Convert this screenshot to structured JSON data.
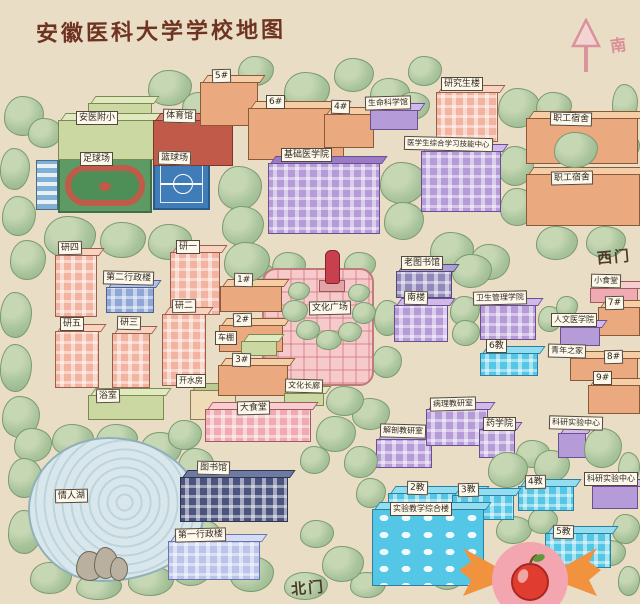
{
  "title": "安徽医科大学学校地图",
  "compass": {
    "label": "南"
  },
  "map": {
    "bg": "#e9ddc6",
    "palettes": {
      "orange": {
        "body": "#eaa97e",
        "top": "#f5cda6",
        "ln": "#8a5a38"
      },
      "pink": {
        "body": "#f2b4a0",
        "top": "#f8d4c0",
        "ln": "#9a5f4a"
      },
      "pinkC": {
        "body": "#f0abb2",
        "top": "#f8cdd0",
        "ln": "#a05a60"
      },
      "purple": {
        "body": "#b69bd9",
        "top": "#cfbae9",
        "ln": "#6c4f92"
      },
      "dpurple": {
        "body": "#9187bb",
        "top": "#aba0cf",
        "ln": "#55497a"
      },
      "cyan": {
        "body": "#55c7e6",
        "top": "#93ddf1",
        "ln": "#2d7fa0"
      },
      "navy": {
        "body": "#4a547e",
        "top": "#6f7aa4",
        "ln": "#2e3550"
      },
      "lav": {
        "body": "#bac4eb",
        "top": "#d5dcf5",
        "ln": "#6a74a8"
      },
      "green": {
        "body": "#cbd8a2",
        "top": "#e1e9c0",
        "ln": "#7c8a52"
      },
      "cream": {
        "body": "#eddcb6",
        "top": "#b9ca92",
        "ln": "#8a7a4e"
      },
      "red": {
        "body": "#c25a4a",
        "top": "#da8272",
        "ln": "#7e352a"
      },
      "blue2": {
        "body": "#8fa7d7",
        "top": "#b3c3e8",
        "ln": "#4e6394"
      }
    },
    "items": [
      {
        "id": "fuxiao-annex",
        "pal": "green",
        "x": 88,
        "y": 103,
        "w": 64,
        "h": 30
      },
      {
        "id": "fuxiao",
        "label": "安医附小",
        "pal": "green",
        "x": 58,
        "y": 120,
        "w": 96,
        "h": 40,
        "lx": 76,
        "ly": 111
      },
      {
        "id": "gym",
        "label": "体育馆",
        "pal": "red",
        "x": 153,
        "y": 120,
        "w": 80,
        "h": 46,
        "lx": 163,
        "ly": 109
      },
      {
        "id": "stands",
        "type": "stands",
        "x": 36,
        "y": 160,
        "w": 22,
        "h": 50
      },
      {
        "id": "football-field",
        "type": "field",
        "label": "足球场",
        "x": 58,
        "y": 158,
        "w": 94,
        "h": 55,
        "lx": 80,
        "ly": 152
      },
      {
        "id": "basketball-court",
        "type": "court",
        "label": "篮球场",
        "x": 153,
        "y": 156,
        "w": 57,
        "h": 54,
        "lx": 158,
        "ly": 151
      },
      {
        "id": "bld5",
        "label": "5#",
        "pal": "orange",
        "x": 200,
        "y": 82,
        "w": 58,
        "h": 44,
        "lx": 212,
        "ly": 69
      },
      {
        "id": "bld6",
        "label": "6#",
        "pal": "orange",
        "x": 248,
        "y": 108,
        "w": 96,
        "h": 52,
        "lx": 266,
        "ly": 95
      },
      {
        "id": "bld4",
        "label": "4#",
        "pal": "orange",
        "x": 324,
        "y": 114,
        "w": 50,
        "h": 34,
        "lx": 331,
        "ly": 100
      },
      {
        "id": "life-science",
        "label": "生命科学馆",
        "pal": "purple",
        "x": 370,
        "y": 110,
        "w": 48,
        "h": 20,
        "lx": 365,
        "ly": 96,
        "fs": 8
      },
      {
        "id": "grad-bld",
        "label": "研究生楼",
        "pal": "pink",
        "x": 436,
        "y": 92,
        "w": 62,
        "h": 50,
        "win": 1,
        "lx": 441,
        "ly": 77
      },
      {
        "id": "staff-dorm-1",
        "label": "职工宿舍",
        "pal": "orange",
        "x": 526,
        "y": 118,
        "w": 112,
        "h": 46,
        "lx": 550,
        "ly": 112
      },
      {
        "id": "staff-dorm-2",
        "label": "职工宿舍",
        "pal": "orange",
        "x": 526,
        "y": 174,
        "w": 114,
        "h": 52,
        "lx": 551,
        "ly": 171
      },
      {
        "id": "basic-medical",
        "label": "基础医学院",
        "pal": "purple",
        "top": "#9a7cc4",
        "x": 268,
        "y": 163,
        "w": 112,
        "h": 71,
        "win": 1,
        "lx": 281,
        "ly": 148
      },
      {
        "id": "skill-center",
        "label": "医学生综合学习技能中心",
        "pal": "purple",
        "x": 421,
        "y": 151,
        "w": 80,
        "h": 61,
        "win": 1,
        "lx": 404,
        "ly": 137,
        "fs": 7.5
      },
      {
        "id": "yan4",
        "label": "研四",
        "pal": "pink",
        "x": 55,
        "y": 255,
        "w": 42,
        "h": 62,
        "win": 1,
        "lx": 58,
        "ly": 241
      },
      {
        "id": "yan1",
        "label": "研一",
        "pal": "pink",
        "x": 170,
        "y": 252,
        "w": 50,
        "h": 63,
        "win": 1,
        "lx": 176,
        "ly": 240
      },
      {
        "id": "admin2",
        "label": "第二行政楼",
        "pal": "blue2",
        "x": 106,
        "y": 287,
        "w": 48,
        "h": 26,
        "win": 1,
        "lx": 103,
        "ly": 271
      },
      {
        "id": "yan2",
        "label": "研二",
        "pal": "pink",
        "x": 162,
        "y": 314,
        "w": 44,
        "h": 72,
        "win": 1,
        "lx": 172,
        "ly": 299
      },
      {
        "id": "yan5",
        "label": "研五",
        "pal": "pink",
        "x": 55,
        "y": 331,
        "w": 44,
        "h": 57,
        "win": 1,
        "lx": 60,
        "ly": 317
      },
      {
        "id": "yan3",
        "label": "研三",
        "pal": "pink",
        "x": 112,
        "y": 333,
        "w": 38,
        "h": 55,
        "win": 1,
        "lx": 117,
        "ly": 316
      },
      {
        "id": "bathhouse",
        "label": "浴室",
        "pal": "green",
        "x": 88,
        "y": 395,
        "w": 76,
        "h": 25,
        "lx": 96,
        "ly": 389
      },
      {
        "id": "hot-water",
        "label": "开水房",
        "pal": "cream",
        "x": 190,
        "y": 390,
        "w": 46,
        "h": 30,
        "lx": 176,
        "ly": 374,
        "fs": 8
      },
      {
        "id": "bld1",
        "label": "1#",
        "pal": "orange",
        "x": 220,
        "y": 286,
        "w": 62,
        "h": 26,
        "lx": 234,
        "ly": 273
      },
      {
        "id": "bld2",
        "label": "2#",
        "pal": "orange",
        "x": 219,
        "y": 325,
        "w": 64,
        "h": 27,
        "lx": 233,
        "ly": 313
      },
      {
        "id": "bike-shed",
        "label": "车棚",
        "pal": "green",
        "x": 241,
        "y": 341,
        "w": 36,
        "h": 15,
        "lx": 215,
        "ly": 331,
        "fs": 8
      },
      {
        "id": "bld3",
        "label": "3#",
        "pal": "orange",
        "x": 218,
        "y": 365,
        "w": 70,
        "h": 31,
        "lx": 232,
        "ly": 353
      },
      {
        "id": "culture-square",
        "type": "plaid",
        "label": "文化广场",
        "x": 262,
        "y": 268,
        "w": 112,
        "h": 118,
        "lx": 309,
        "ly": 301
      },
      {
        "id": "statue",
        "type": "statue",
        "x": 319,
        "y": 250,
        "w": 24,
        "h": 42
      },
      {
        "id": "culture-corridor",
        "label": "文化长廊",
        "pal": "green",
        "x": 284,
        "y": 393,
        "w": 40,
        "h": 13,
        "lx": 285,
        "ly": 379,
        "fs": 8
      },
      {
        "id": "canteen-big",
        "label": "大食堂",
        "pal": "pinkC",
        "x": 205,
        "y": 409,
        "w": 106,
        "h": 33,
        "win": 1,
        "lx": 237,
        "ly": 401
      },
      {
        "id": "old-library",
        "label": "老图书馆",
        "pal": "dpurple",
        "x": 396,
        "y": 271,
        "w": 56,
        "h": 27,
        "win": 1,
        "lx": 401,
        "ly": 256
      },
      {
        "id": "south-bld",
        "label": "南楼",
        "pal": "purple",
        "x": 394,
        "y": 305,
        "w": 54,
        "h": 37,
        "win": 1,
        "lx": 404,
        "ly": 291
      },
      {
        "id": "health-mgmt",
        "label": "卫生管理学院",
        "pal": "purple",
        "x": 480,
        "y": 305,
        "w": 56,
        "h": 35,
        "win": 1,
        "lx": 473,
        "ly": 291,
        "fs": 8
      },
      {
        "id": "jiao6",
        "label": "6教",
        "pal": "cyan",
        "x": 480,
        "y": 353,
        "w": 58,
        "h": 23,
        "win": 1,
        "lx": 486,
        "ly": 339
      },
      {
        "id": "small-canteen",
        "label": "小食堂",
        "pal": "pinkC",
        "x": 590,
        "y": 288,
        "w": 48,
        "h": 15,
        "lx": 591,
        "ly": 274,
        "fs": 8
      },
      {
        "id": "bld7",
        "label": "7#",
        "pal": "orange",
        "x": 598,
        "y": 307,
        "w": 42,
        "h": 29,
        "lx": 605,
        "ly": 296
      },
      {
        "id": "humanities",
        "label": "人文医学院",
        "pal": "purple",
        "x": 560,
        "y": 327,
        "w": 40,
        "h": 19,
        "lx": 551,
        "ly": 313,
        "fs": 8
      },
      {
        "id": "youth-home",
        "type": "label-only",
        "label": "青年之家",
        "lx": 548,
        "ly": 344,
        "fs": 8
      },
      {
        "id": "bld8",
        "label": "8#",
        "pal": "orange",
        "x": 570,
        "y": 358,
        "w": 68,
        "h": 23,
        "lx": 604,
        "ly": 350
      },
      {
        "id": "bld9",
        "label": "9#",
        "pal": "orange",
        "x": 588,
        "y": 385,
        "w": 52,
        "h": 29,
        "lx": 593,
        "ly": 371
      },
      {
        "id": "anatomy",
        "label": "解剖教研室",
        "pal": "purple",
        "x": 376,
        "y": 439,
        "w": 56,
        "h": 29,
        "win": 1,
        "lx": 380,
        "ly": 424,
        "fs": 8
      },
      {
        "id": "pathology",
        "label": "病理教研室",
        "pal": "purple",
        "x": 426,
        "y": 409,
        "w": 62,
        "h": 37,
        "win": 1,
        "lx": 430,
        "ly": 397,
        "fs": 8
      },
      {
        "id": "pharmacy",
        "label": "药学院",
        "pal": "purple",
        "x": 479,
        "y": 429,
        "w": 36,
        "h": 29,
        "win": 1,
        "lx": 483,
        "ly": 417
      },
      {
        "id": "research-center-1",
        "label": "科研实验中心",
        "pal": "purple",
        "x": 558,
        "y": 433,
        "w": 28,
        "h": 25,
        "lx": 549,
        "ly": 416,
        "fs": 8
      },
      {
        "id": "jiao4",
        "label": "4教",
        "pal": "cyan",
        "x": 518,
        "y": 486,
        "w": 56,
        "h": 25,
        "win": 1,
        "lx": 525,
        "ly": 475
      },
      {
        "id": "research-center-2",
        "label": "科研实验中心",
        "pal": "purple",
        "x": 592,
        "y": 486,
        "w": 46,
        "h": 23,
        "lx": 584,
        "ly": 472,
        "fs": 8
      },
      {
        "id": "jiao2",
        "label": "2教",
        "pal": "cyan",
        "x": 388,
        "y": 493,
        "w": 94,
        "h": 23,
        "win": 1,
        "lx": 407,
        "ly": 481
      },
      {
        "id": "jiao3",
        "label": "3教",
        "pal": "cyan",
        "x": 452,
        "y": 495,
        "w": 62,
        "h": 25,
        "win": 1,
        "lx": 458,
        "ly": 483
      },
      {
        "id": "exp-teaching",
        "label": "实验教学综合楼",
        "pal": "cyan",
        "x": 372,
        "y": 509,
        "w": 112,
        "h": 77,
        "win": "oval",
        "lx": 390,
        "ly": 502,
        "fs": 8
      },
      {
        "id": "jiao5",
        "label": "5教",
        "pal": "cyan",
        "x": 545,
        "y": 533,
        "w": 66,
        "h": 35,
        "win": 1,
        "lx": 553,
        "ly": 525
      },
      {
        "id": "lovers-lake",
        "type": "lake",
        "label": "情人湖",
        "x": 28,
        "y": 437,
        "w": 176,
        "h": 145,
        "lx": 55,
        "ly": 489
      },
      {
        "id": "rocks",
        "type": "rocks",
        "x": 76,
        "y": 545,
        "w": 50,
        "h": 34
      },
      {
        "id": "library",
        "label": "图书馆",
        "pal": "navy",
        "x": 180,
        "y": 477,
        "w": 108,
        "h": 45,
        "win": 1,
        "lx": 197,
        "ly": 461
      },
      {
        "id": "admin1",
        "label": "第一行政楼",
        "pal": "lav",
        "x": 168,
        "y": 541,
        "w": 92,
        "h": 39,
        "win": 1,
        "lx": 175,
        "ly": 528
      },
      {
        "id": "west-gate",
        "type": "gate",
        "label": "西门",
        "lx": 597,
        "ly": 246
      },
      {
        "id": "north-gate",
        "type": "gate",
        "label": "北门",
        "lx": 291,
        "ly": 577
      }
    ]
  },
  "decor": {
    "trees": [
      [
        4,
        96,
        40,
        40
      ],
      [
        28,
        118,
        34,
        30
      ],
      [
        0,
        148,
        30,
        42
      ],
      [
        2,
        196,
        34,
        40
      ],
      [
        148,
        70,
        44,
        36
      ],
      [
        182,
        92,
        36,
        30
      ],
      [
        238,
        56,
        36,
        30
      ],
      [
        284,
        72,
        46,
        38
      ],
      [
        334,
        58,
        40,
        34
      ],
      [
        370,
        78,
        40,
        32
      ],
      [
        408,
        56,
        34,
        30
      ],
      [
        396,
        92,
        34,
        28
      ],
      [
        498,
        88,
        42,
        40
      ],
      [
        536,
        92,
        36,
        30
      ],
      [
        612,
        84,
        26,
        40
      ],
      [
        554,
        132,
        44,
        36,
        1
      ],
      [
        604,
        132,
        36,
        30
      ],
      [
        498,
        146,
        36,
        40
      ],
      [
        500,
        188,
        36,
        38
      ],
      [
        536,
        226,
        42,
        34
      ],
      [
        586,
        226,
        40,
        32
      ],
      [
        44,
        216,
        52,
        42
      ],
      [
        100,
        222,
        46,
        36
      ],
      [
        148,
        224,
        44,
        36
      ],
      [
        10,
        240,
        36,
        40
      ],
      [
        0,
        292,
        32,
        46
      ],
      [
        0,
        344,
        32,
        48
      ],
      [
        2,
        396,
        38,
        42
      ],
      [
        218,
        166,
        44,
        44
      ],
      [
        222,
        206,
        42,
        40
      ],
      [
        224,
        242,
        46,
        40,
        1
      ],
      [
        190,
        280,
        26,
        30
      ],
      [
        380,
        162,
        46,
        42
      ],
      [
        384,
        202,
        40,
        38
      ],
      [
        430,
        232,
        44,
        38
      ],
      [
        470,
        244,
        40,
        36
      ],
      [
        272,
        252,
        34,
        28
      ],
      [
        344,
        252,
        32,
        26
      ],
      [
        374,
        300,
        28,
        36
      ],
      [
        372,
        346,
        30,
        32
      ],
      [
        326,
        386,
        38,
        30,
        1
      ],
      [
        246,
        262,
        28,
        24
      ],
      [
        452,
        254,
        40,
        34
      ],
      [
        450,
        296,
        30,
        30
      ],
      [
        452,
        320,
        28,
        26
      ],
      [
        538,
        306,
        24,
        26
      ],
      [
        556,
        296,
        22,
        22
      ],
      [
        14,
        428,
        38,
        34
      ],
      [
        52,
        424,
        42,
        32
      ],
      [
        96,
        424,
        42,
        32
      ],
      [
        140,
        432,
        42,
        34
      ],
      [
        178,
        448,
        36,
        36
      ],
      [
        192,
        482,
        32,
        40
      ],
      [
        188,
        520,
        34,
        38
      ],
      [
        172,
        552,
        40,
        34
      ],
      [
        128,
        566,
        46,
        30
      ],
      [
        76,
        574,
        46,
        26
      ],
      [
        30,
        562,
        42,
        32
      ],
      [
        8,
        510,
        34,
        44
      ],
      [
        8,
        458,
        34,
        40
      ],
      [
        168,
        420,
        34,
        30
      ],
      [
        316,
        416,
        40,
        36,
        1
      ],
      [
        352,
        398,
        38,
        32
      ],
      [
        300,
        446,
        30,
        28
      ],
      [
        344,
        446,
        34,
        32,
        1
      ],
      [
        356,
        478,
        30,
        30
      ],
      [
        300,
        520,
        34,
        28
      ],
      [
        322,
        546,
        42,
        36,
        1
      ],
      [
        284,
        572,
        44,
        28
      ],
      [
        350,
        572,
        36,
        26
      ],
      [
        230,
        556,
        44,
        36
      ],
      [
        488,
        452,
        40,
        36,
        1
      ],
      [
        516,
        440,
        34,
        28
      ],
      [
        584,
        428,
        38,
        40,
        1
      ],
      [
        618,
        452,
        22,
        34
      ],
      [
        534,
        450,
        36,
        32
      ],
      [
        496,
        516,
        36,
        28
      ],
      [
        528,
        508,
        30,
        26
      ],
      [
        612,
        514,
        28,
        30
      ],
      [
        596,
        540,
        30,
        26
      ],
      [
        618,
        566,
        22,
        30
      ],
      [
        430,
        556,
        36,
        34
      ],
      [
        282,
        300,
        26,
        22,
        1
      ],
      [
        296,
        320,
        24,
        20,
        1
      ],
      [
        316,
        330,
        26,
        20,
        1
      ],
      [
        338,
        322,
        24,
        20,
        1
      ],
      [
        352,
        302,
        24,
        22,
        1
      ],
      [
        288,
        282,
        22,
        18,
        1
      ],
      [
        348,
        284,
        22,
        18,
        1
      ]
    ]
  }
}
